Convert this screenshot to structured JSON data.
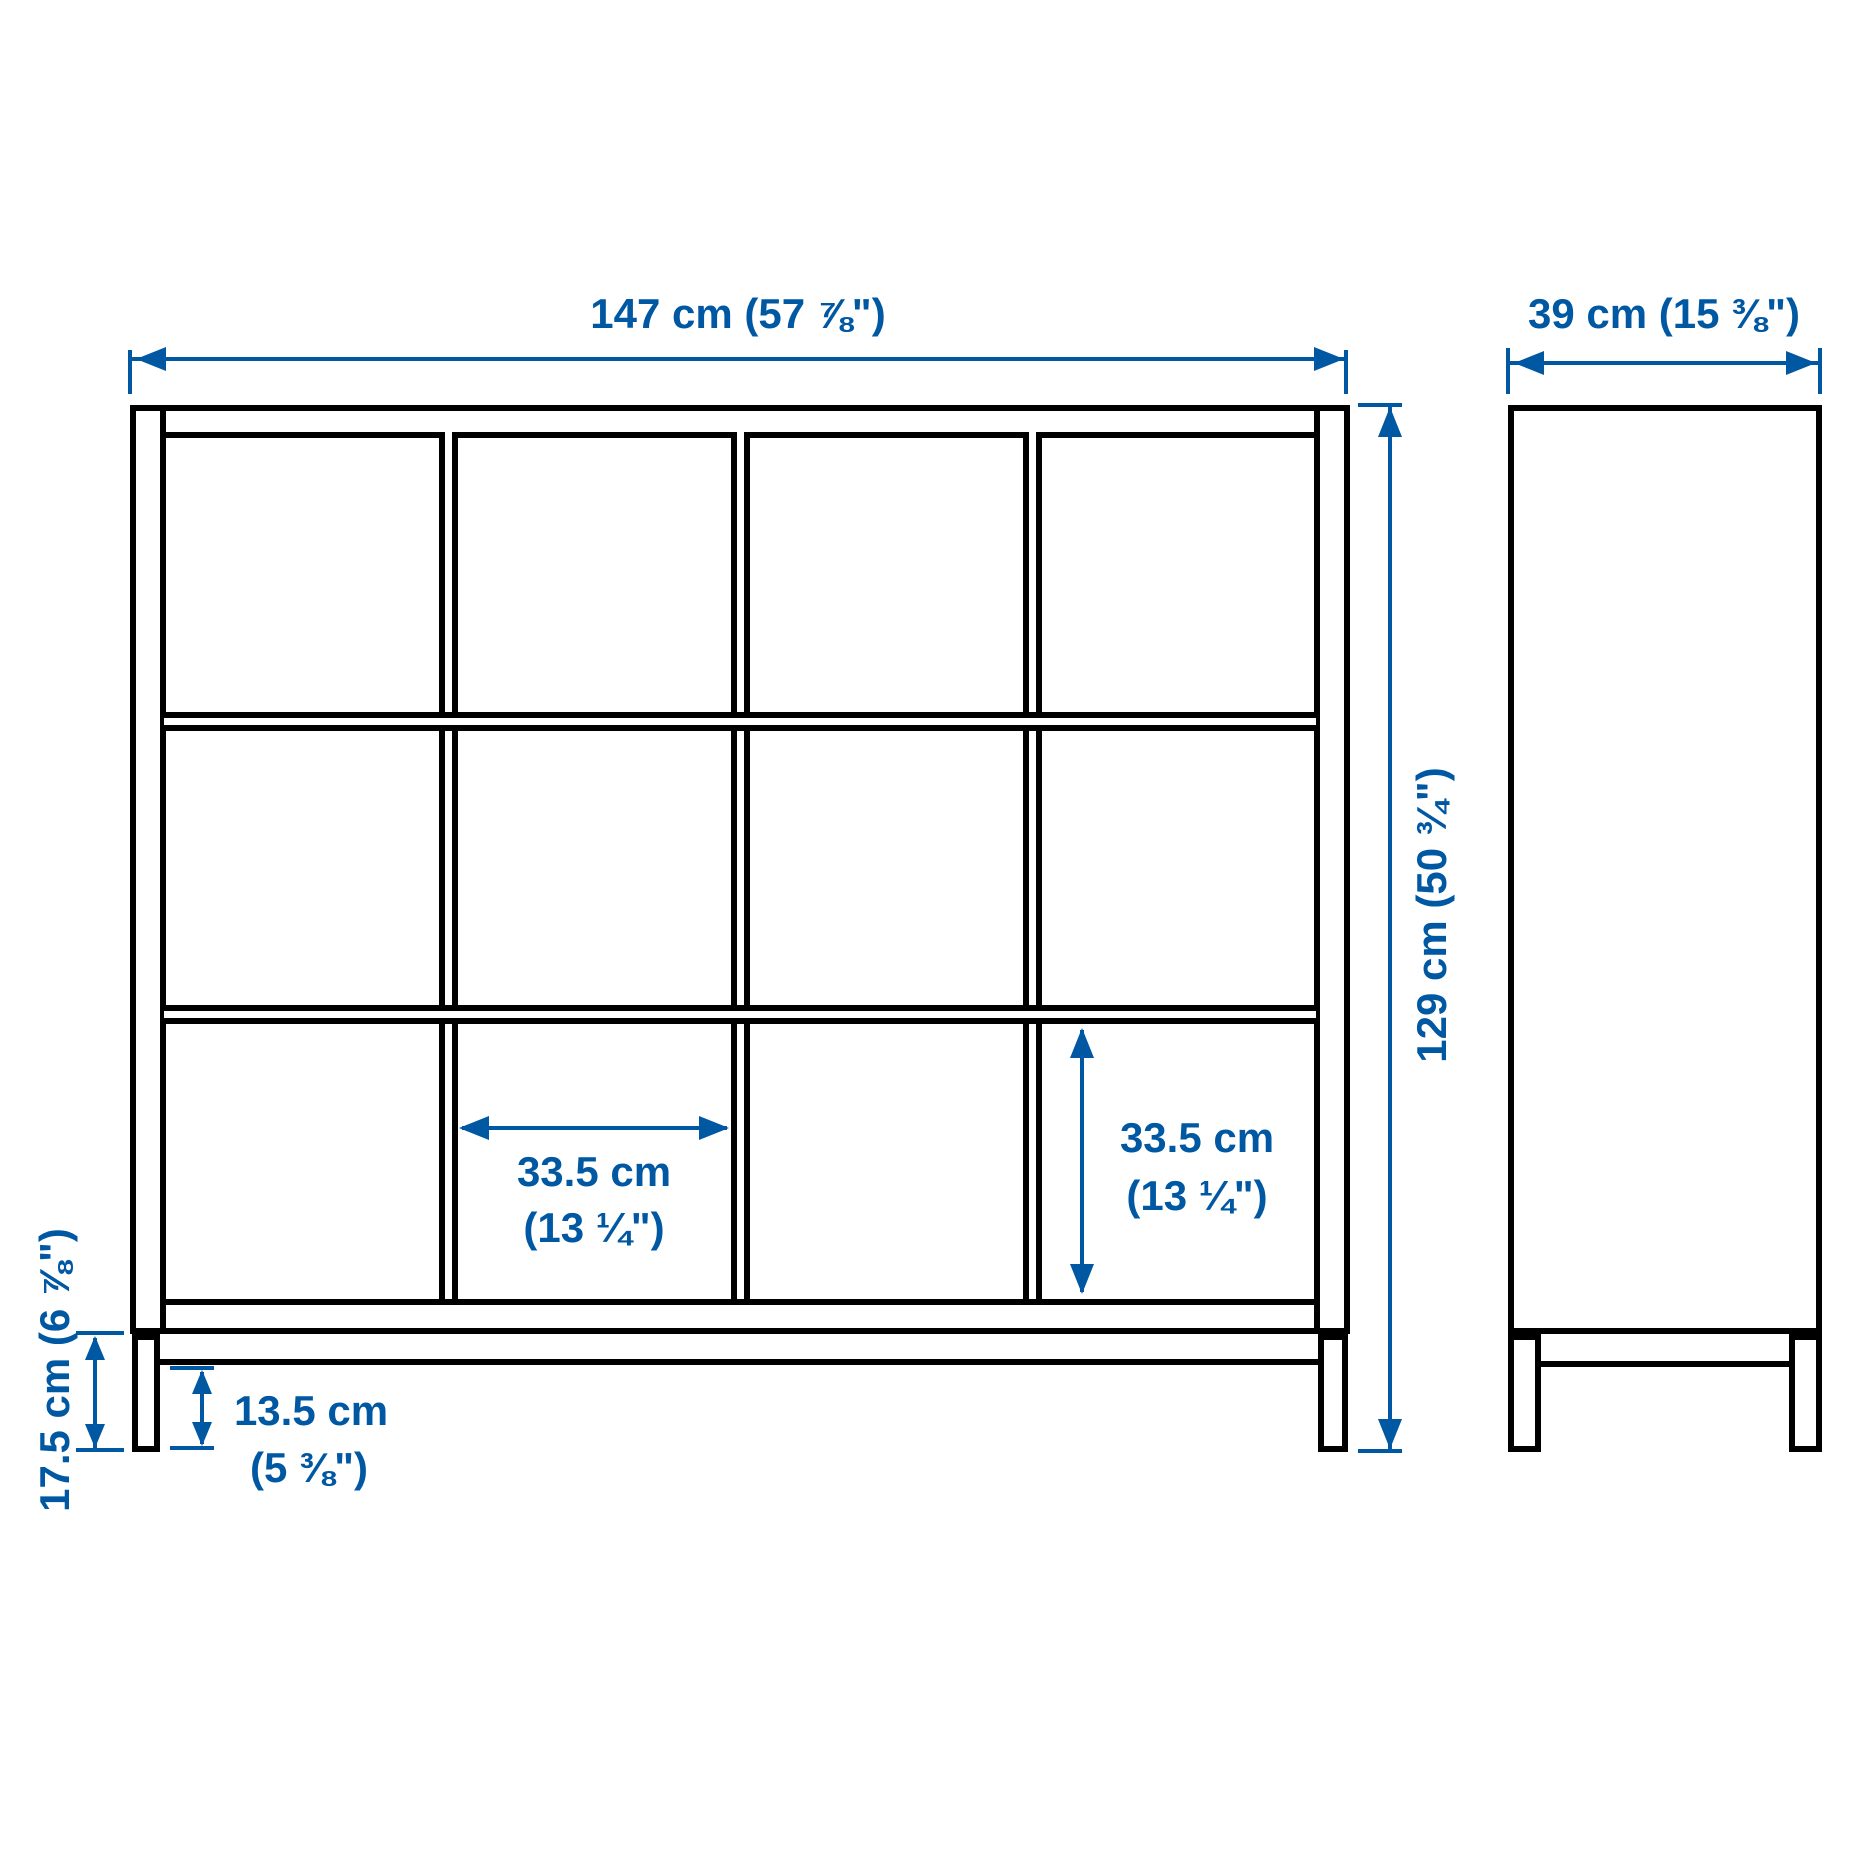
{
  "colors": {
    "dimension": "#0058a3",
    "outline": "#000000",
    "background": "#ffffff"
  },
  "structure": {
    "views": [
      "front",
      "side"
    ],
    "grid": {
      "columns": 4,
      "rows": 3,
      "open_cells": 12
    }
  },
  "dimensions": {
    "front_width": {
      "label": "147 cm (57 ⅞\")"
    },
    "depth": {
      "label": "39 cm (15 ⅜\")"
    },
    "height": {
      "label": "129 cm (50 ¾\")"
    },
    "cell_width": {
      "line1": "33.5 cm",
      "line2": "(13 ¼\")"
    },
    "cell_height": {
      "line1": "33.5 cm",
      "line2": "(13 ¼\")"
    },
    "underframe_height": {
      "label": "17.5 cm (6 ⅞\")"
    },
    "underframe_clearance": {
      "line1": "13.5 cm",
      "line2": "(5 ⅜\")"
    }
  }
}
